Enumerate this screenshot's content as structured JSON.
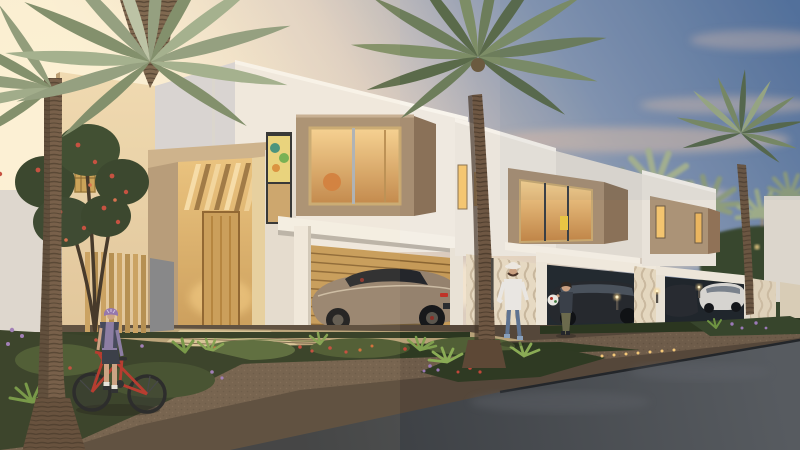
{
  "scene": {
    "description": "dusk architectural rendering of a modern townhouse community with palm trees",
    "objects": [
      "evening-sky",
      "clouds",
      "palm-trees",
      "townhouse-row",
      "glowing-windows",
      "entrance-portal",
      "carports",
      "sports-car",
      "parked-cars",
      "woman-walking",
      "child-with-ball",
      "boy-with-bicycle",
      "flower-garden",
      "stone-walkway",
      "gravel-path",
      "asphalt-road",
      "wooden-fence",
      "path-lights",
      "frangipani-tree"
    ]
  },
  "colors": {
    "sky_top": "#54719c",
    "sky_upper": "#8495b1",
    "sky_warm": "#d5c6bd",
    "sky_horizon": "#f3e2c6",
    "sun_glow": "#fdf3d9",
    "cloud_pink": "#ddbfaa",
    "cloud_cream": "#f6e8d0",
    "wall_white": "#efe9e0",
    "wall_white_shade": "#d7d3d4",
    "wall_beige_light": "#efdab2",
    "wall_beige": "#dfc49a",
    "wall_taupe": "#a78e72",
    "wall_taupe_dark": "#8a7158",
    "window_glow_light": "#f6d190",
    "window_glow_deep": "#bf8447",
    "door_wood": "#c89a55",
    "slat_wall": "#c59a58",
    "palm_dark": "#526244",
    "palm_green": "#6d7d5b",
    "palm_sage": "#8d9b7d",
    "palm_light": "#b7c1a5",
    "palm_trunk": "#6e5743",
    "trunk_dark": "#46362a",
    "garden_dark": "#2e3a22",
    "garden_green": "#49582f",
    "leaf_bright": "#7fa04e",
    "flower_red": "#c2473a",
    "flower_orange": "#d06a35",
    "flower_purple": "#9b79b8",
    "paver_tan": "#b7a178",
    "paver_light": "#d6c296",
    "gravel": "#6e5c4a",
    "road_dark": "#383b3f",
    "road_light": "#575b60",
    "car_bronze": "#95826e",
    "car_dark": "#26292e",
    "car_white": "#d6d4d0",
    "jeans": "#5e7391",
    "shirt_white": "#e9e6e2",
    "helmet_purple": "#8d6fae",
    "bike_red": "#b23127",
    "skin": "#c99f80",
    "ball_white": "#e8e6e0",
    "fence_wood": "#c89f5e",
    "light_warm": "#ffd98e"
  }
}
